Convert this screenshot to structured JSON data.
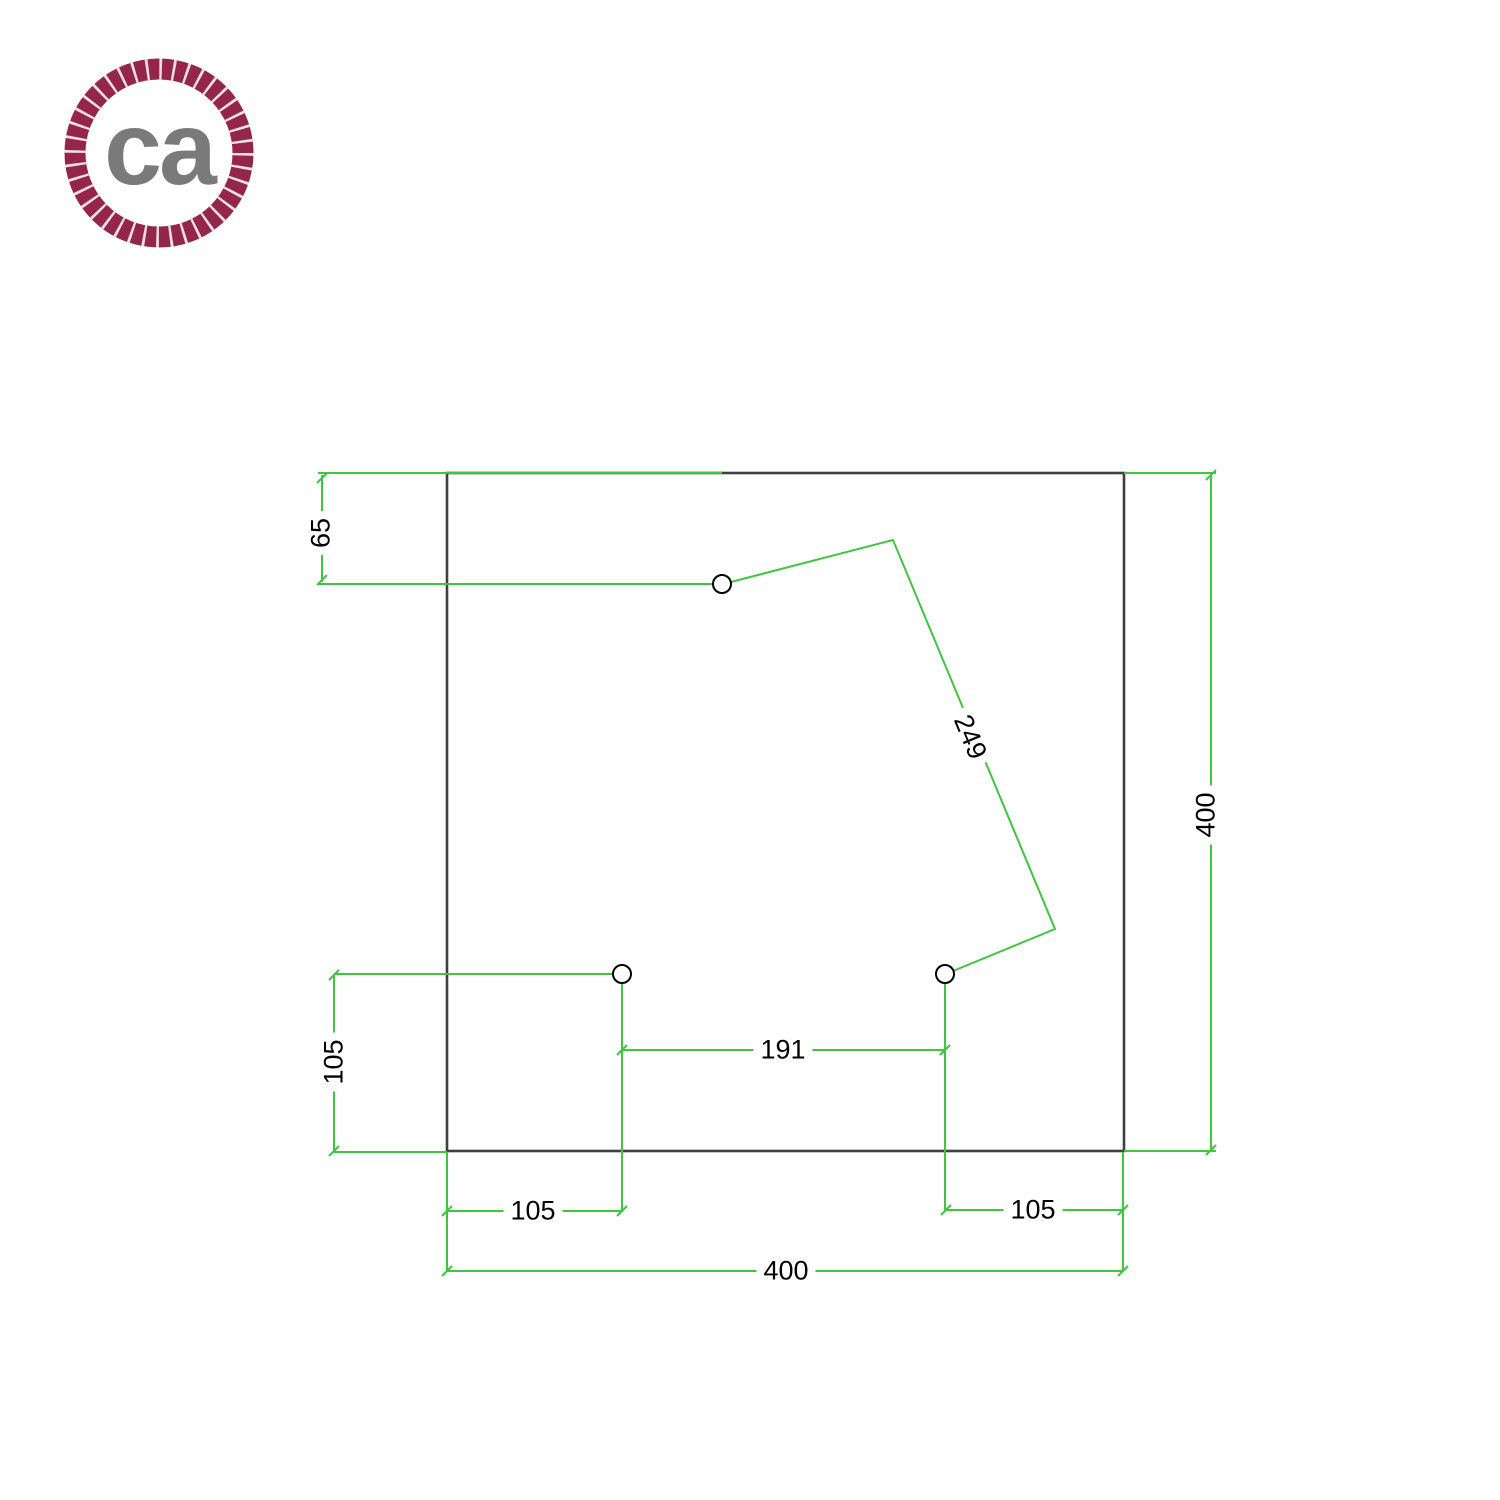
{
  "logo": {
    "text": "ca",
    "ring_color": "#93264a",
    "text_color": "#7a7a7a"
  },
  "colors": {
    "dimension_green": "#3fc63f",
    "outline_dark": "#3f3f3f",
    "hole_stroke": "#000000",
    "label_text": "#000000",
    "background": "#ffffff"
  },
  "drawing": {
    "outline_shape": "square",
    "holes_count": 3,
    "dim_labels": {
      "top_offset": "65",
      "diagonal": "249",
      "right_side": "400",
      "left_offset": "105",
      "hole_spacing": "191",
      "bottom_left": "105",
      "bottom_right": "105",
      "bottom_width": "400"
    }
  }
}
